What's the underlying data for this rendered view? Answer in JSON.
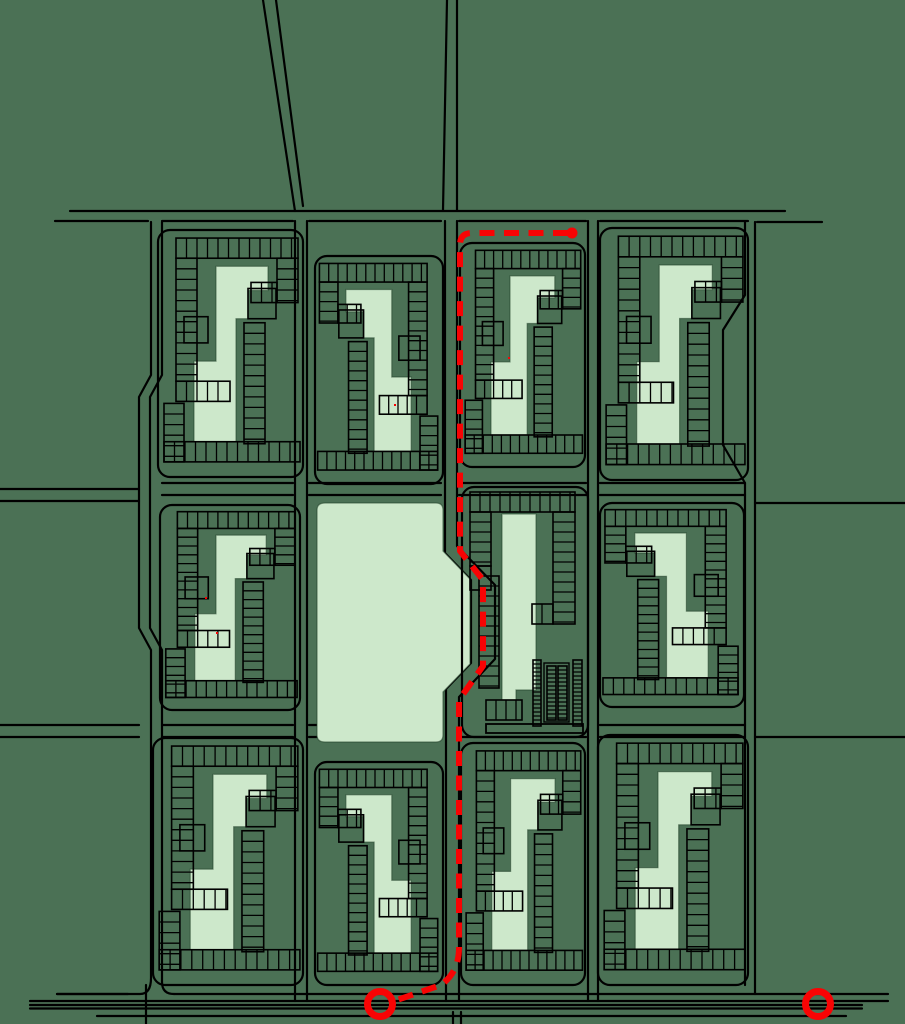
{
  "canvas": {
    "width": 905,
    "height": 1024
  },
  "colors": {
    "background": "#4b7155",
    "building_fill": "#cde8cb",
    "building_outline": "rgba(35,65,42,0.55)",
    "road_line": "#000000",
    "route_red": "#f80404"
  },
  "roads": [
    "M263 0 L295 211",
    "M276 0 L303 206",
    "M447 0 L443 210",
    "M457 0 V210",
    "M70 211 H785",
    "M55 221 H148",
    "M162 221 H293",
    "M309 221 H441",
    "M459 221 H586",
    "M600 221 H748",
    "M757 222 H822",
    "M151 222 V375 L139 397 V628 L151 650 V978 Q151 994 140 994 H57",
    "M162 222 V375 L150 397 V628 L162 650 V982 Q162 994 174 994",
    "M174 994 H888",
    "M0 489 H139",
    "M0 501 H139",
    "M0 725 H139",
    "M0 737 H139",
    "M755 222 V994",
    "M745 222 V295 L723 330 V445 L745 483 V985",
    "M755 503 H905",
    "M755 737 H905",
    "M295 221 V1001",
    "M307 221 V1001",
    "M445 221 V553 L471 580 V663 L446 689 V1001",
    "M457 221 V546 L495 585 V659 L459 697 V1001",
    "M588 221 V1001",
    "M598 221 V1001",
    "M162 483 H293",
    "M309 483 H441",
    "M459 483 H586",
    "M600 483 H745",
    "M162 495 H293",
    "M309 495 H441",
    "M459 495 H586",
    "M600 495 H745",
    "M162 725 H293",
    "M309 725 H441",
    "M600 725 H745",
    "M162 737 H293",
    "M309 737 H441",
    "M459 737 H586",
    "M600 737 H745",
    "M57 994 H128",
    "M30 1001 H888",
    "M30 1005 H862",
    "M30 1008.5 H862",
    "M97 1016 H846",
    "M146 985 V1024",
    "M453 1012 V1024",
    "M461 1012 V1024"
  ],
  "block_archetype": {
    "ref_w": 145,
    "ref_h": 245,
    "strips": [
      [
        18,
        8,
        140,
        28
      ],
      [
        18,
        28,
        39,
        150
      ],
      [
        18,
        150,
        72,
        170
      ],
      [
        119,
        28,
        140,
        72
      ],
      [
        93,
        52,
        119,
        72
      ],
      [
        86,
        92,
        107,
        212
      ],
      [
        6,
        172,
        26,
        230
      ],
      [
        6,
        210,
        142,
        230
      ]
    ],
    "boxes": [
      [
        90,
        58,
        28,
        30
      ],
      [
        26,
        86,
        24,
        26
      ]
    ],
    "tower": [
      [
        58,
        36
      ],
      [
        110,
        36
      ],
      [
        110,
        60
      ],
      [
        90,
        60
      ],
      [
        90,
        88
      ],
      [
        78,
        88
      ],
      [
        78,
        210
      ],
      [
        36,
        210
      ],
      [
        36,
        130
      ],
      [
        58,
        130
      ]
    ],
    "rung_gap": 10.5
  },
  "blocks": [
    {
      "x": 158,
      "y": 230,
      "w": 145,
      "h": 247,
      "mirror": false
    },
    {
      "x": 315,
      "y": 256,
      "w": 128,
      "h": 228,
      "mirror": true
    },
    {
      "x": 460,
      "y": 243,
      "w": 125,
      "h": 224,
      "mirror": false
    },
    {
      "x": 600,
      "y": 228,
      "w": 148,
      "h": 252,
      "mirror": false
    },
    {
      "x": 160,
      "y": 505,
      "w": 140,
      "h": 205,
      "mirror": false
    },
    {
      "x": 600,
      "y": 503,
      "w": 144,
      "h": 204,
      "mirror": true
    },
    {
      "x": 153,
      "y": 738,
      "w": 150,
      "h": 247,
      "mirror": false
    },
    {
      "x": 315,
      "y": 762,
      "w": 128,
      "h": 223,
      "mirror": true
    },
    {
      "x": 461,
      "y": 743,
      "w": 124,
      "h": 242,
      "mirror": false
    },
    {
      "x": 598,
      "y": 735,
      "w": 150,
      "h": 250,
      "mirror": false
    }
  ],
  "park": {
    "path": "M325 503 H436 Q443 503 443 510 V551 L470 579 V664 L443 692 V735 Q443 742 436 742 H325 Q317 742 317 735 V510 Q317 503 325 503 Z"
  },
  "central_block": {
    "ring": [
      462,
      487,
      126,
      250
    ],
    "strips": [
      [
        470,
        492,
        575,
        512
      ],
      [
        553,
        512,
        575,
        624
      ],
      [
        532,
        604,
        553,
        624
      ],
      [
        470,
        512,
        491,
        566
      ],
      [
        479,
        576,
        499,
        688
      ],
      [
        486,
        700,
        522,
        720
      ]
    ],
    "boxes": [
      [
        470,
        566,
        21,
        24
      ]
    ],
    "slab": "M502 514 H536 V690 H516 V700 H502 Z",
    "dense_ladders": [
      [
        533,
        660,
        541,
        726
      ],
      [
        547,
        666,
        556,
        720
      ],
      [
        558,
        666,
        567,
        720
      ],
      [
        573,
        660,
        582,
        726
      ]
    ],
    "dense_gap": 4,
    "dense_frame": [
      544,
      663,
      25,
      59
    ],
    "bottom_bar": [
      486,
      724,
      97,
      9
    ]
  },
  "route": {
    "path": "M568 233 H472 Q460 233 460 245 V551 L483 580 V666 L459 700 V948 Q459 972 441 985 L397 1000",
    "dash": "15 9.5",
    "width": 6,
    "end_dot": {
      "cx": 572,
      "cy": 233,
      "r": 5.5
    },
    "start_circle": {
      "cx": 380,
      "cy": 1004,
      "r": 12.5,
      "stroke_width": 7
    },
    "alt_circle": {
      "cx": 818,
      "cy": 1004,
      "r": 12.5,
      "stroke_width": 7
    }
  },
  "stray_marks": [
    [
      508,
      357
    ],
    [
      394,
      404
    ],
    [
      205,
      597
    ],
    [
      216,
      632
    ]
  ]
}
